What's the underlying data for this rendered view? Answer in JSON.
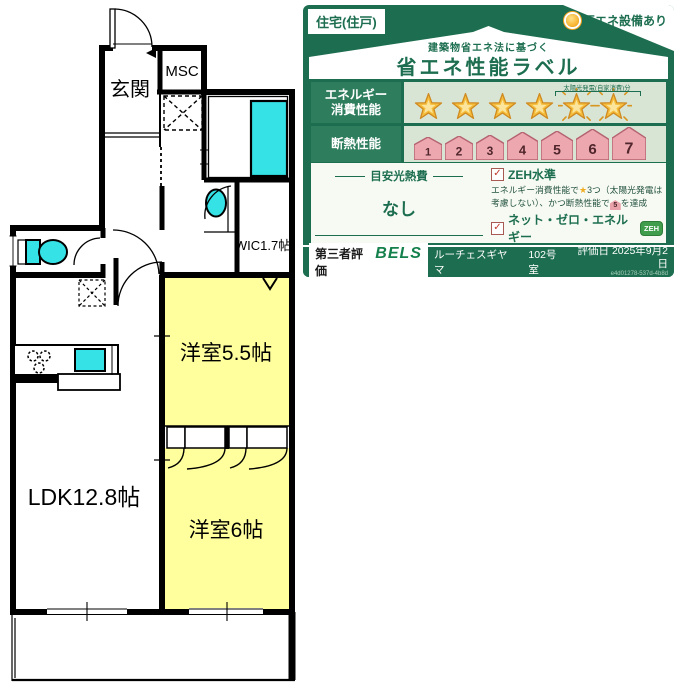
{
  "floor_plan": {
    "labels": {
      "genkan": "玄関",
      "msc": "MSC",
      "wic": "WIC1.7帖",
      "bedroom_small": "洋室5.5帖",
      "ldk": "LDK12.8帖",
      "bedroom_large": "洋室6帖"
    },
    "colors": {
      "room_fill": "#ffff9d",
      "fixture_fill": "#35e2e6",
      "wall": "#000000"
    }
  },
  "energy_label": {
    "property_type": "住宅(住戸)",
    "renewable": "再エネ設備あり",
    "subtitle": "建築物省エネ法に基づく",
    "title": "省エネ性能ラベル",
    "check_glyph": "✓",
    "energy_row": {
      "label_line1": "エネルギー",
      "label_line2": "消費性能",
      "stars_filled": 4,
      "stars_solar": 2,
      "solar_note": "太陽光発電(自家消費)分"
    },
    "insulation_row": {
      "label": "断熱性能",
      "levels": [
        "1",
        "2",
        "3",
        "4",
        "5",
        "6",
        "7"
      ]
    },
    "utility_cost": {
      "label": "目安光熱費",
      "value": "なし"
    },
    "zeh_level": {
      "label": "ZEH水準",
      "desc_part1": "エネルギー消費性能で",
      "desc_part2": "3つ（太陽光発電",
      "desc_part3": "は考慮しない）、かつ断熱性能で",
      "house_grade": "5",
      "desc_part4": "を達成"
    },
    "net_zero": {
      "label": "ネット・ゼロ・エネルギー",
      "badge": "ZEH",
      "desc": "太陽光発電の売電分も含めてエネルギー収支がゼロ以下を達成"
    },
    "footer": {
      "cert_label": "第三者評価",
      "cert_name": "BELS",
      "building": "ルーチェスギヤマ",
      "unit": "102号室",
      "date_label": "評価日",
      "date": "2025年9月2日",
      "code": "e4d01278-537d-4b8d"
    },
    "icons": {
      "renewable": "sun-icon",
      "check": "checkbox-check-icon",
      "star": "star-icon",
      "solar_star": "solar-star-icon",
      "insulation": "house-icon"
    },
    "colors": {
      "green": "#1d6e50",
      "row_bg": "#d8e4d4",
      "star_gold": "#f5bd3b",
      "house_pink": "#eca7af"
    }
  }
}
